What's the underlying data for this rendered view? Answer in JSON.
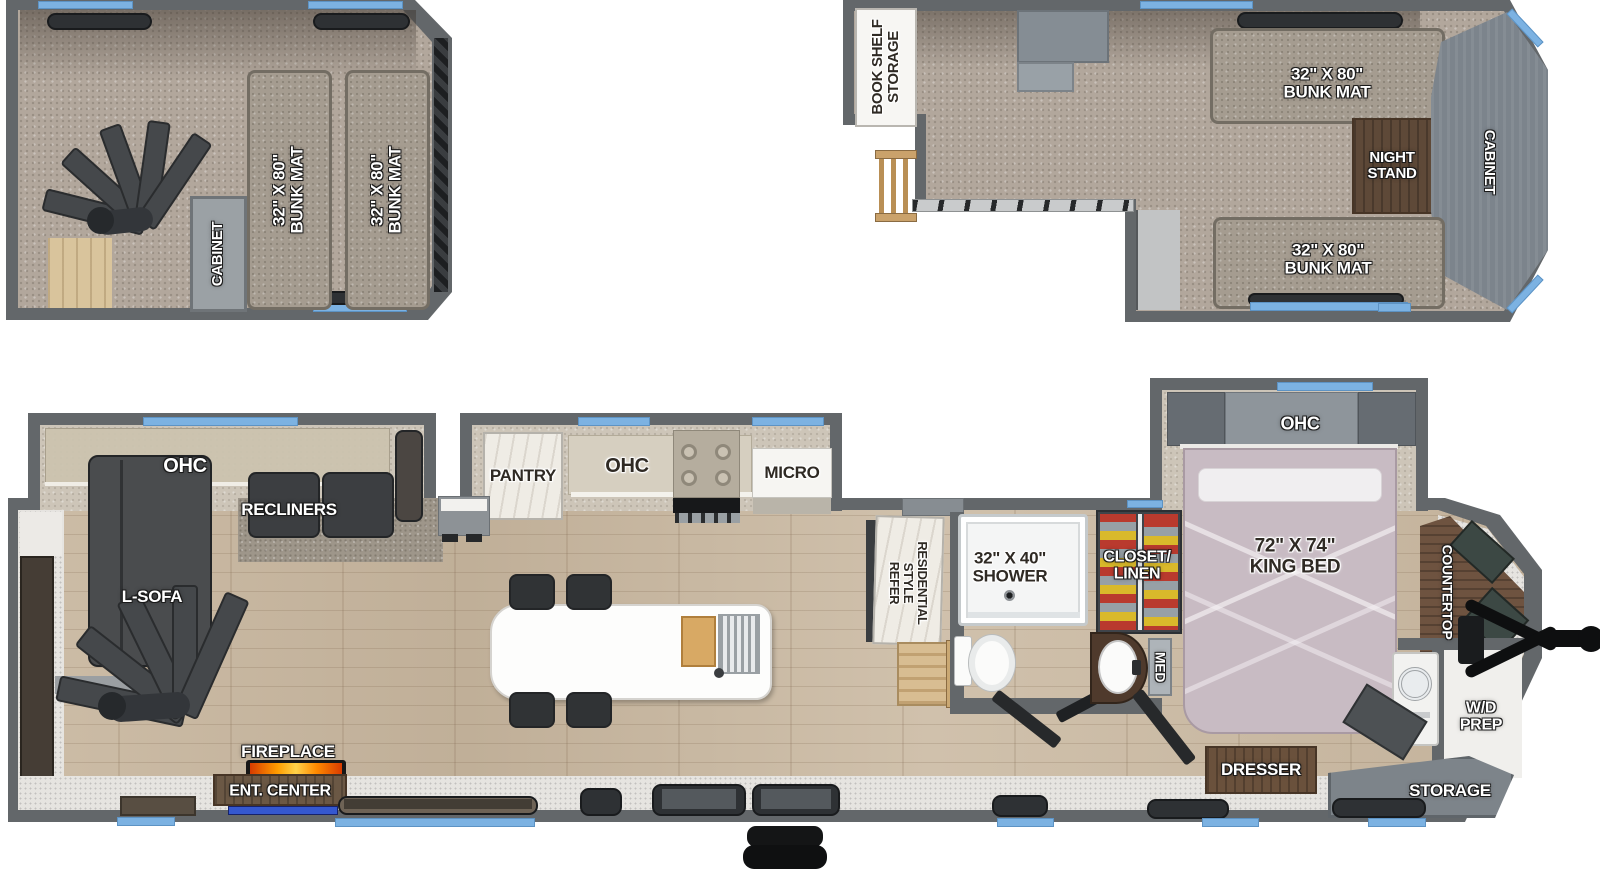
{
  "title": "RV destination trailer floorplan with two lofts",
  "colors": {
    "window_blue": "#7cb2e2",
    "wall_gray": "#63676a",
    "carpet_tan": "#b2a79c",
    "wood_floor": "#c9b9a3",
    "led_accent_blue": "#3558cf",
    "flame_orange": "#ff9d00",
    "bed_mauve": "#c8bbc3"
  },
  "loft_left": {
    "bunk_mat_left": "32\" X 80\"\nBUNK MAT",
    "bunk_mat_right": "32\" X 80\"\nBUNK MAT",
    "cabinet": "CABINET"
  },
  "loft_right": {
    "book_shelf_storage": "BOOK SHELF\nSTORAGE",
    "bunk_mat_top": "32\" X 80\"\nBUNK MAT",
    "night_stand": "NIGHT\nSTAND",
    "cabinet": "CABINET",
    "bunk_mat_bottom": "32\" X 80\"\nBUNK MAT"
  },
  "main": {
    "living": {
      "ohc": "OHC",
      "recliners": "RECLINERS",
      "l_sofa": "L-SOFA",
      "fireplace": "FIREPLACE",
      "ent_center": "ENT. CENTER"
    },
    "kitchen": {
      "pantry": "PANTRY",
      "ohc": "OHC",
      "micro": "MICRO",
      "refer": "RESIDENTIAL\nSTYLE\nREFER"
    },
    "bath": {
      "shower": "32\" X 40\"\nSHOWER",
      "closet": "CLOSET/\nLINEN",
      "med": "MED"
    },
    "bedroom": {
      "ohc": "OHC",
      "king_bed": "72\" X 74\"\nKING BED",
      "dresser": "DRESSER"
    },
    "front": {
      "countertop": "COUNTERTOP",
      "wd_prep": "W/D\nPREP",
      "storage": "STORAGE"
    }
  }
}
